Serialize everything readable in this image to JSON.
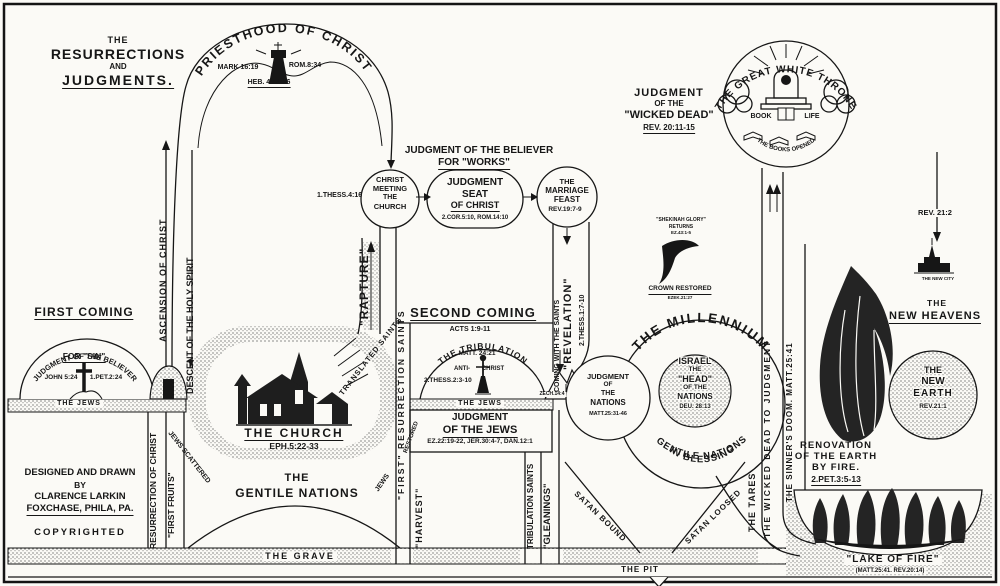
{
  "header": {
    "l1": "THE",
    "l2": "RESURRECTIONS",
    "l3": "AND",
    "l4": "JUDGMENTS."
  },
  "priesthood": {
    "arc": "PRIESTHOOD OF CHRIST",
    "mark": "MARK 16:19",
    "rom": "ROM.8:34",
    "heb": "HEB. 4:14-16",
    "ascension": "ASCENSION OF CHRIST",
    "descent": "DESCENT OF THE HOLY SPIRIT"
  },
  "works": {
    "h1": "JUDGMENT OF THE BELIEVER",
    "h2": "FOR \"WORKS\"",
    "thess": "1.THESS.4:16",
    "meeting": {
      "l1": "CHRIST",
      "l2": "MEETING",
      "l3": "THE",
      "l4": "CHURCH"
    },
    "seat": {
      "l1": "JUDGMENT",
      "l2": "SEAT",
      "l3": "OF CHRIST",
      "refs": "2.COR.5:10, ROM.14:10"
    },
    "feast": {
      "l1": "THE",
      "l2": "MARRIAGE",
      "l3": "FEAST",
      "ref": "REV.19:7-9"
    }
  },
  "rapture": {
    "label": "\"RAPTURE\"",
    "translated": "TRANSLATED SAINTS"
  },
  "first_coming": {
    "heading": "FIRST COMING",
    "arc": "JUDGMENT OF THE BELIEVER",
    "for_sin": "FOR \"SIN\"",
    "john": "JOHN 5:24",
    "pet": "1.PET.2:24",
    "jews": "THE JEWS"
  },
  "church": {
    "name": "THE CHURCH",
    "ref": "EPH.5:22-33",
    "gentile1": "THE",
    "gentile2": "GENTILE NATIONS",
    "scattered": "JEWS SCATTERED"
  },
  "pillar1": {
    "first_res": "\"FIRST\" RESURRECTION SAINTS",
    "jews": "JEWS",
    "restored": "RESTORED",
    "harvest": "\"HARVEST\""
  },
  "second_coming": {
    "heading": "SECOND COMING",
    "acts": "ACTS 1:9-11"
  },
  "tribulation": {
    "arc": "THE TRIBULATION",
    "matt": "MATT. 24:21",
    "anti": "ANTI-",
    "christ": "CHRIST",
    "thess": "2.THESS.2:3-10",
    "jews": "THE JEWS",
    "zech": "ZECH.14:4"
  },
  "jews_judgment": {
    "l1": "JUDGMENT",
    "l2": "OF THE JEWS",
    "refs": "EZ.22:19-22, JER.30:4-7, DAN.12:1"
  },
  "pillar2": {
    "saints": "TRIBULATION SAINTS",
    "gleanings": "\"GLEANINGS\""
  },
  "revelation": {
    "coming": "COMING WITH THE SAINTS",
    "name": "\"REVELATION\"",
    "thess": "2.THESS.1:7-10"
  },
  "nations": {
    "l1": "JUDGMENT",
    "l2": "OF",
    "l3": "THE",
    "l4": "NATIONS",
    "ref": "MATT.25:31-46"
  },
  "millennium": {
    "arc": "THE MILLENNIUM",
    "bless1": "GENTILE NATIONS",
    "bless2": "IN BLESSING",
    "israel": {
      "l1": "ISRAEL",
      "l2": "THE",
      "l3": "\"HEAD\"",
      "l4": "OF THE",
      "l5": "NATIONS",
      "ref": "DEU. 28:13"
    },
    "satan_bound": "SATAN BOUND",
    "satan_loosed": "SATAN LOOSED",
    "tares": "THE TARES"
  },
  "shekinah": {
    "l1": "\"SHEKINAH GLORY\"",
    "l2": "RETURNS",
    "l3": "EZ.43:1-5",
    "crown1": "CROWN RESTORED",
    "crown2": "EZEK.21:27"
  },
  "throne": {
    "arc": "THE GREAT WHITE THRONE",
    "book": "BOOK",
    "life": "LIFE",
    "books_opened": "THE BOOKS OPENED"
  },
  "wicked": {
    "l1": "JUDGMENT",
    "l2": "OF THE",
    "l3": "\"WICKED DEAD\"",
    "ref": "REV. 20:11-15",
    "to_judgment": "THE WICKED DEAD TO JUDGMENT",
    "doom": "THE SINNER'S DOOM. MATT.25:41"
  },
  "renovation": {
    "l1": "RENOVATION",
    "l2": "OF THE EARTH",
    "l3": "BY FIRE.",
    "ref": "2.PET.3:5-13"
  },
  "lake": {
    "name": "\"LAKE OF FIRE\"",
    "refs": "(MATT.25:41. REV.20:14)"
  },
  "new_heavens": {
    "rev": "REV. 21:2",
    "city": "THE NEW CITY",
    "l1": "THE",
    "l2": "NEW HEAVENS",
    "earth": {
      "l1": "THE",
      "l2": "NEW",
      "l3": "EARTH",
      "ref": "REV.21:1"
    }
  },
  "ground": {
    "grave": "THE GRAVE",
    "pit": "THE PIT"
  },
  "credits": {
    "l1": "DESIGNED AND DRAWN",
    "l2": "BY",
    "l3": "CLARENCE LARKIN",
    "l4": "FOXCHASE, PHILA, PA.",
    "l5": "COPYRIGHTED",
    "res": "RESURRECTION OF CHRIST",
    "fruits": "\"FIRST FRUITS\""
  }
}
